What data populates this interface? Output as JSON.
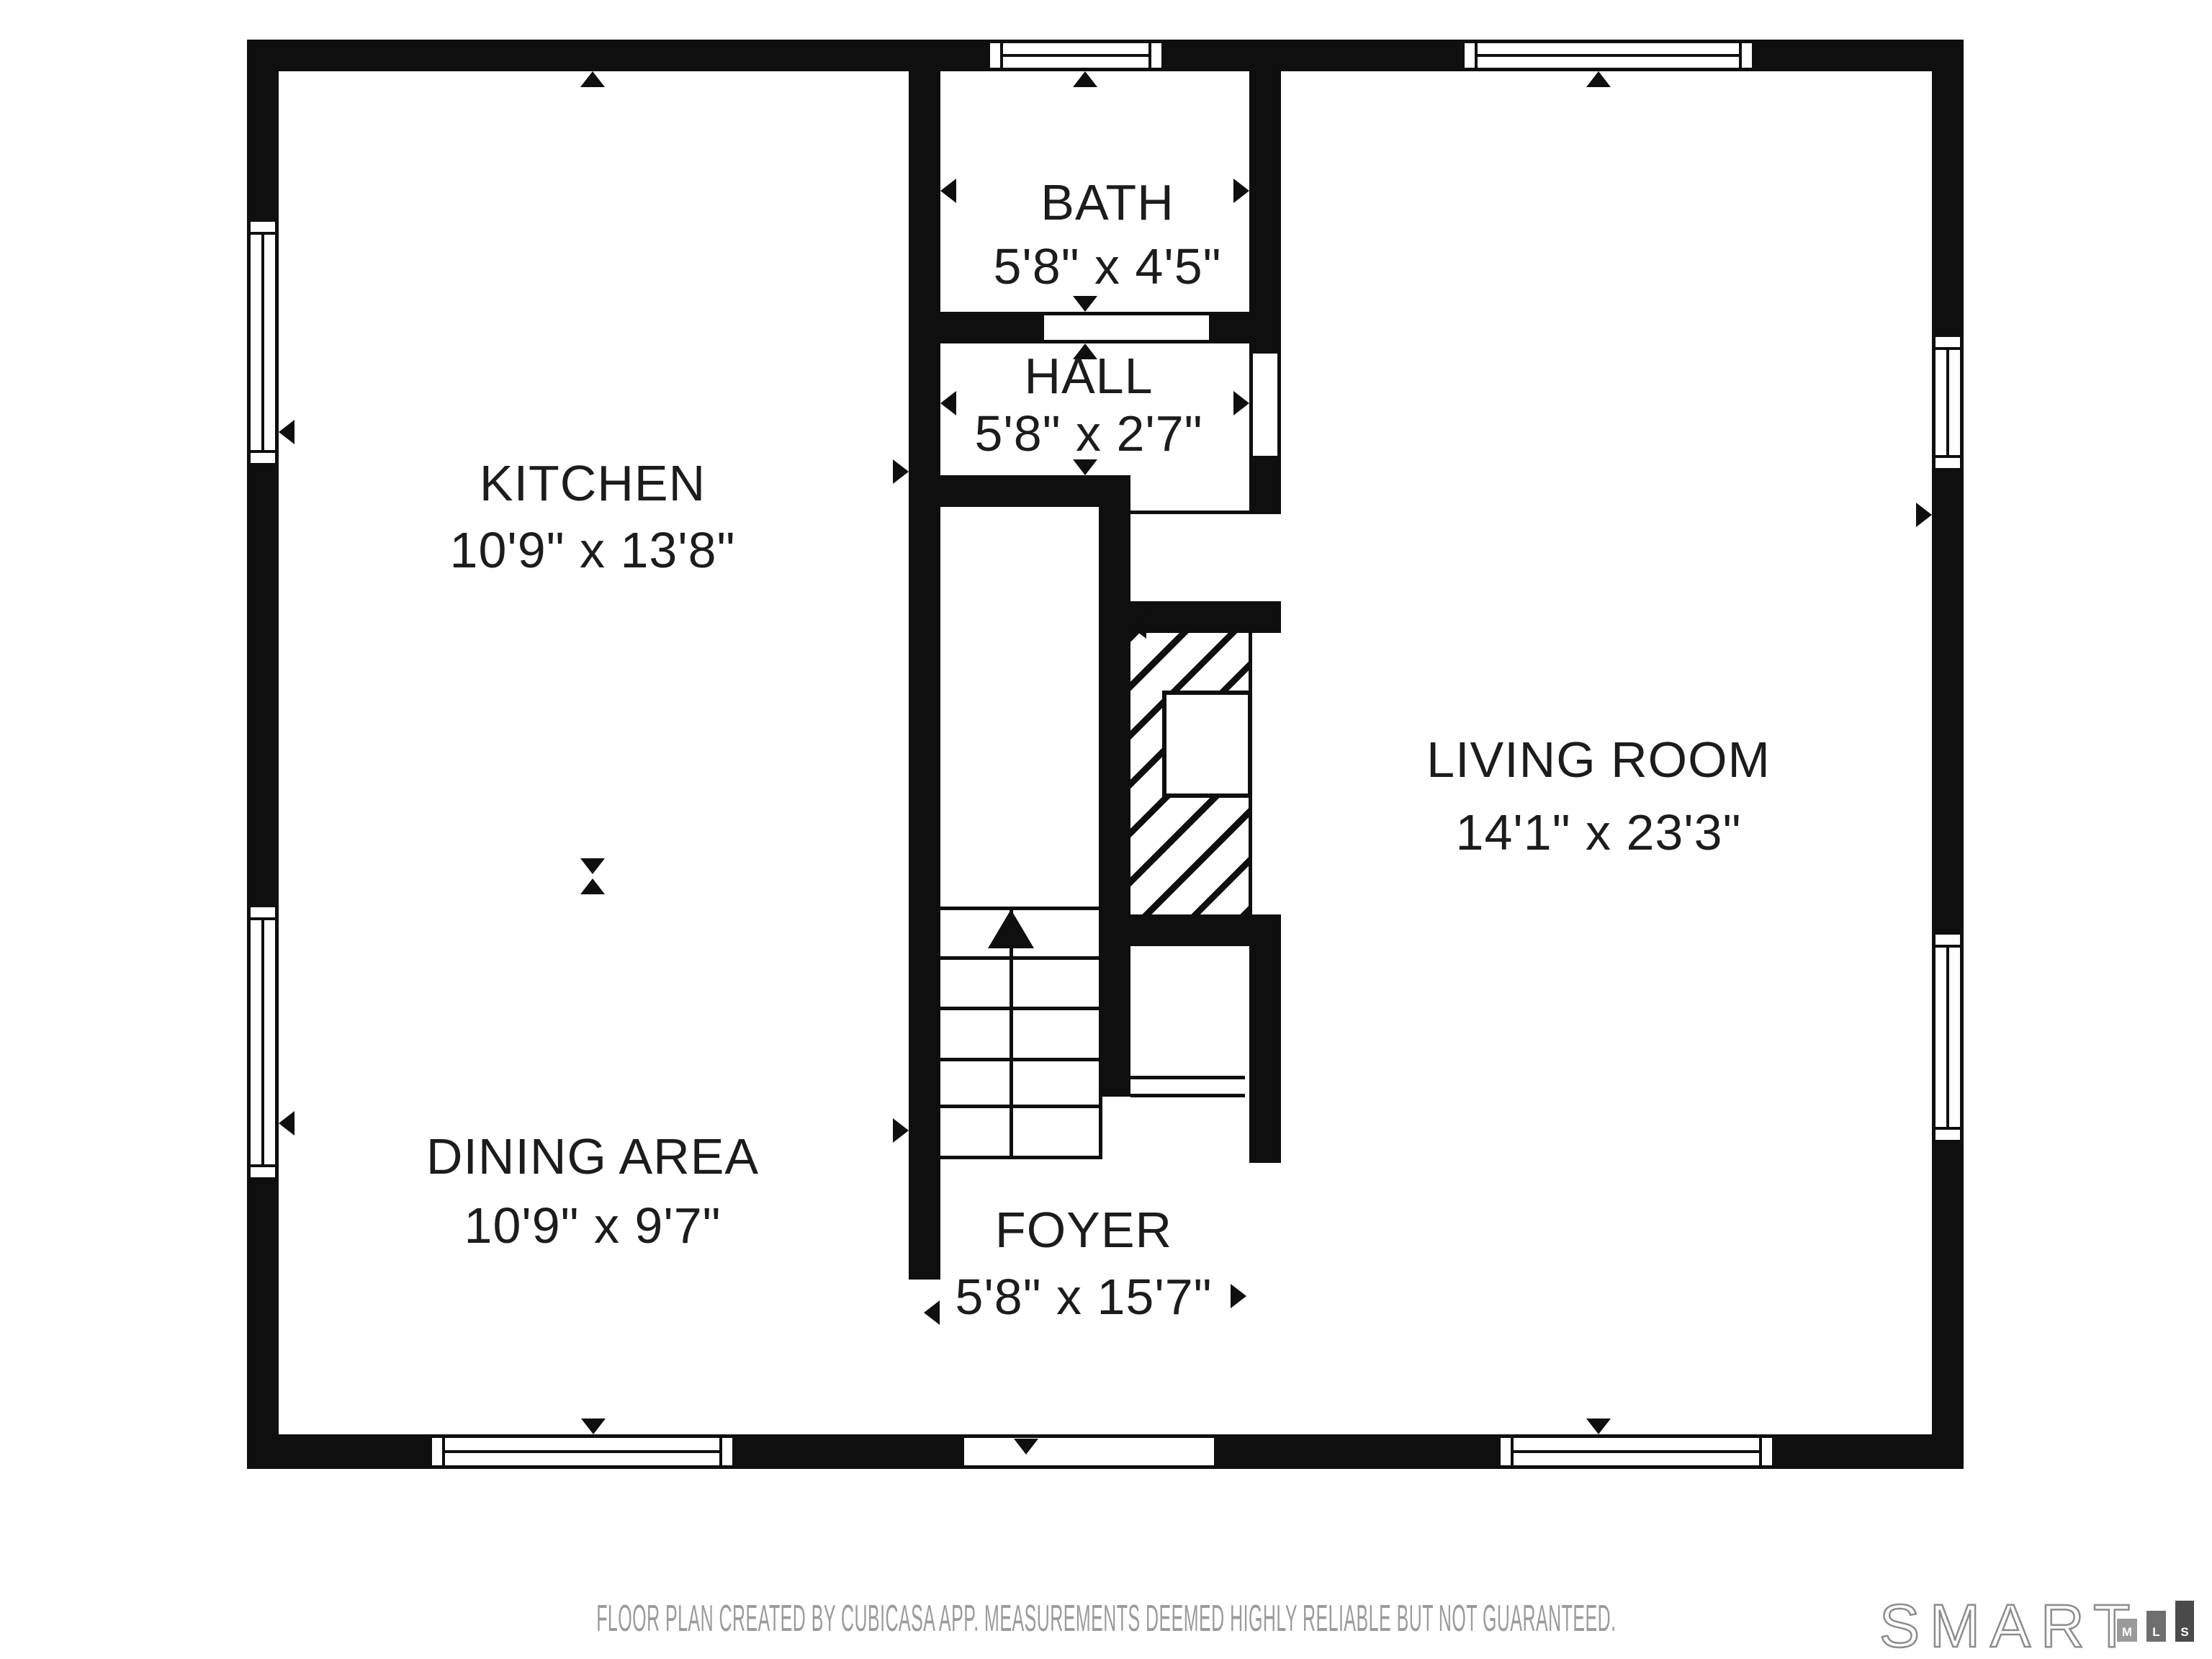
{
  "plan": {
    "rooms": [
      {
        "key": "kitchen",
        "name": "KITCHEN",
        "dims": "10'9\" x 13'8\""
      },
      {
        "key": "bath",
        "name": "BATH",
        "dims": "5'8\" x 4'5\""
      },
      {
        "key": "hall",
        "name": "HALL",
        "dims": "5'8\" x 2'7\""
      },
      {
        "key": "living-room",
        "name": "LIVING ROOM",
        "dims": "14'1\" x 23'3\""
      },
      {
        "key": "dining-area",
        "name": "DINING AREA",
        "dims": "10'9\" x 9'7\""
      },
      {
        "key": "foyer",
        "name": "FOYER",
        "dims": "5'8\" x 15'7\""
      }
    ],
    "glyphs": {
      "stairs_arrow": "up",
      "entry_arrow": "down",
      "window_symbol": "double-pane-window",
      "fireplace_symbol": "diagonal-hatch-chimney"
    }
  },
  "footer": {
    "disclaimer": "FLOOR PLAN CREATED BY CUBICASA APP. MEASUREMENTS DEEMED HIGHLY RELIABLE BUT NOT GUARANTEED."
  },
  "logo": {
    "word": "SMART",
    "blocks": [
      {
        "label": "M"
      },
      {
        "label": "L"
      },
      {
        "label": "S"
      }
    ]
  },
  "colors": {
    "wall": "#0f0f0f",
    "text": "#1c1c1c",
    "footer_text": "#9b9b9b",
    "logo_outline": "#8c8c8c",
    "logo_block_m": "#9a9a9a",
    "logo_block_l": "#6e6e6e",
    "logo_block_s": "#4a4a4a",
    "background": "#ffffff"
  }
}
